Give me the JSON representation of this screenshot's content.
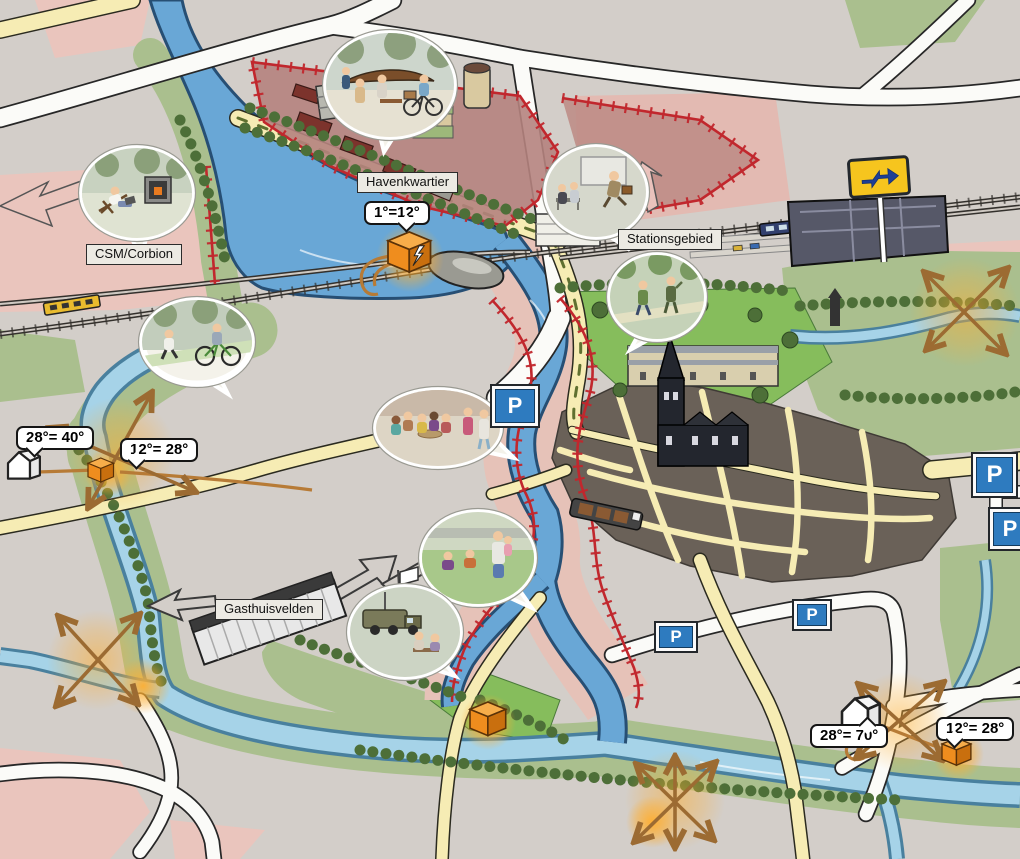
{
  "map_title": "Illustrated city heat-network map",
  "area_labels": [
    {
      "id": "havenkwartier",
      "text": "Havenkwartier"
    },
    {
      "id": "csm-corbion",
      "text": "CSM/Corbion"
    },
    {
      "id": "stationsgebied",
      "text": "Stationsgebied"
    },
    {
      "id": "gasthuisvelden",
      "text": "Gasthuisvelden"
    }
  ],
  "callouts": [
    {
      "id": "havenkwartier-heat-source",
      "text": "1°=12°"
    },
    {
      "id": "west-house",
      "text": "28°= 40°"
    },
    {
      "id": "west-heat-source",
      "text": "12°= 28°"
    },
    {
      "id": "southeast-house",
      "text": "28°= 70°"
    },
    {
      "id": "southeast-heat-source",
      "text": "12°= 28°"
    }
  ],
  "signs": {
    "parking_label": "P",
    "parking_count": 5
  },
  "colors": {
    "background": "#d3cec9",
    "water_main": "#69a7d6",
    "water_light": "#a6d3e8",
    "road_yellow": "#f6ecb4",
    "road_white": "#fbfbf8",
    "park_green": "#86bd5c",
    "belt_green": "#aabf8e",
    "zone_red_border": "#c1272d",
    "zone_pink": "#eac5bd",
    "heat_orange": "#f29024",
    "parking_blue": "#2e7bbf",
    "ns_yellow": "#f6c51e",
    "ns_blue": "#1e3f96",
    "city_dark": "#6a6158"
  },
  "icons": {
    "ns-logo": "dutch-railways-double-arrow",
    "parking-sign": "white P on blue square",
    "heat-source-box": "orange 3D box with glow",
    "lightning-bolt": "lightning bolt on heat source",
    "heat-house": "white house marker",
    "heat-pipe": "orange pipeline",
    "flow-arrow-cross": "orange double-headed crossing arrows",
    "church-tower": "tall church with spire",
    "station-building": "dark station complex",
    "train": "train on railway",
    "container": "white shipping container",
    "army-truck": "olive military truck",
    "boat": "barge on canal"
  },
  "vignettes": [
    {
      "id": "v1",
      "scene": "boat-building-workshop-and-cargo-bike"
    },
    {
      "id": "v2",
      "scene": "person-relaxing-with-laptop-and-3d-printer"
    },
    {
      "id": "v3",
      "scene": "jogger-and-cyclist-on-path"
    },
    {
      "id": "v4",
      "scene": "commuters-rushing-at-station"
    },
    {
      "id": "v5",
      "scene": "two-people-walking-in-park"
    },
    {
      "id": "v6",
      "scene": "crowded-cafe-terrace"
    },
    {
      "id": "v7",
      "scene": "family-relaxing-at-waterside"
    },
    {
      "id": "v8",
      "scene": "army-truck-with-visitors-on-bench"
    }
  ]
}
